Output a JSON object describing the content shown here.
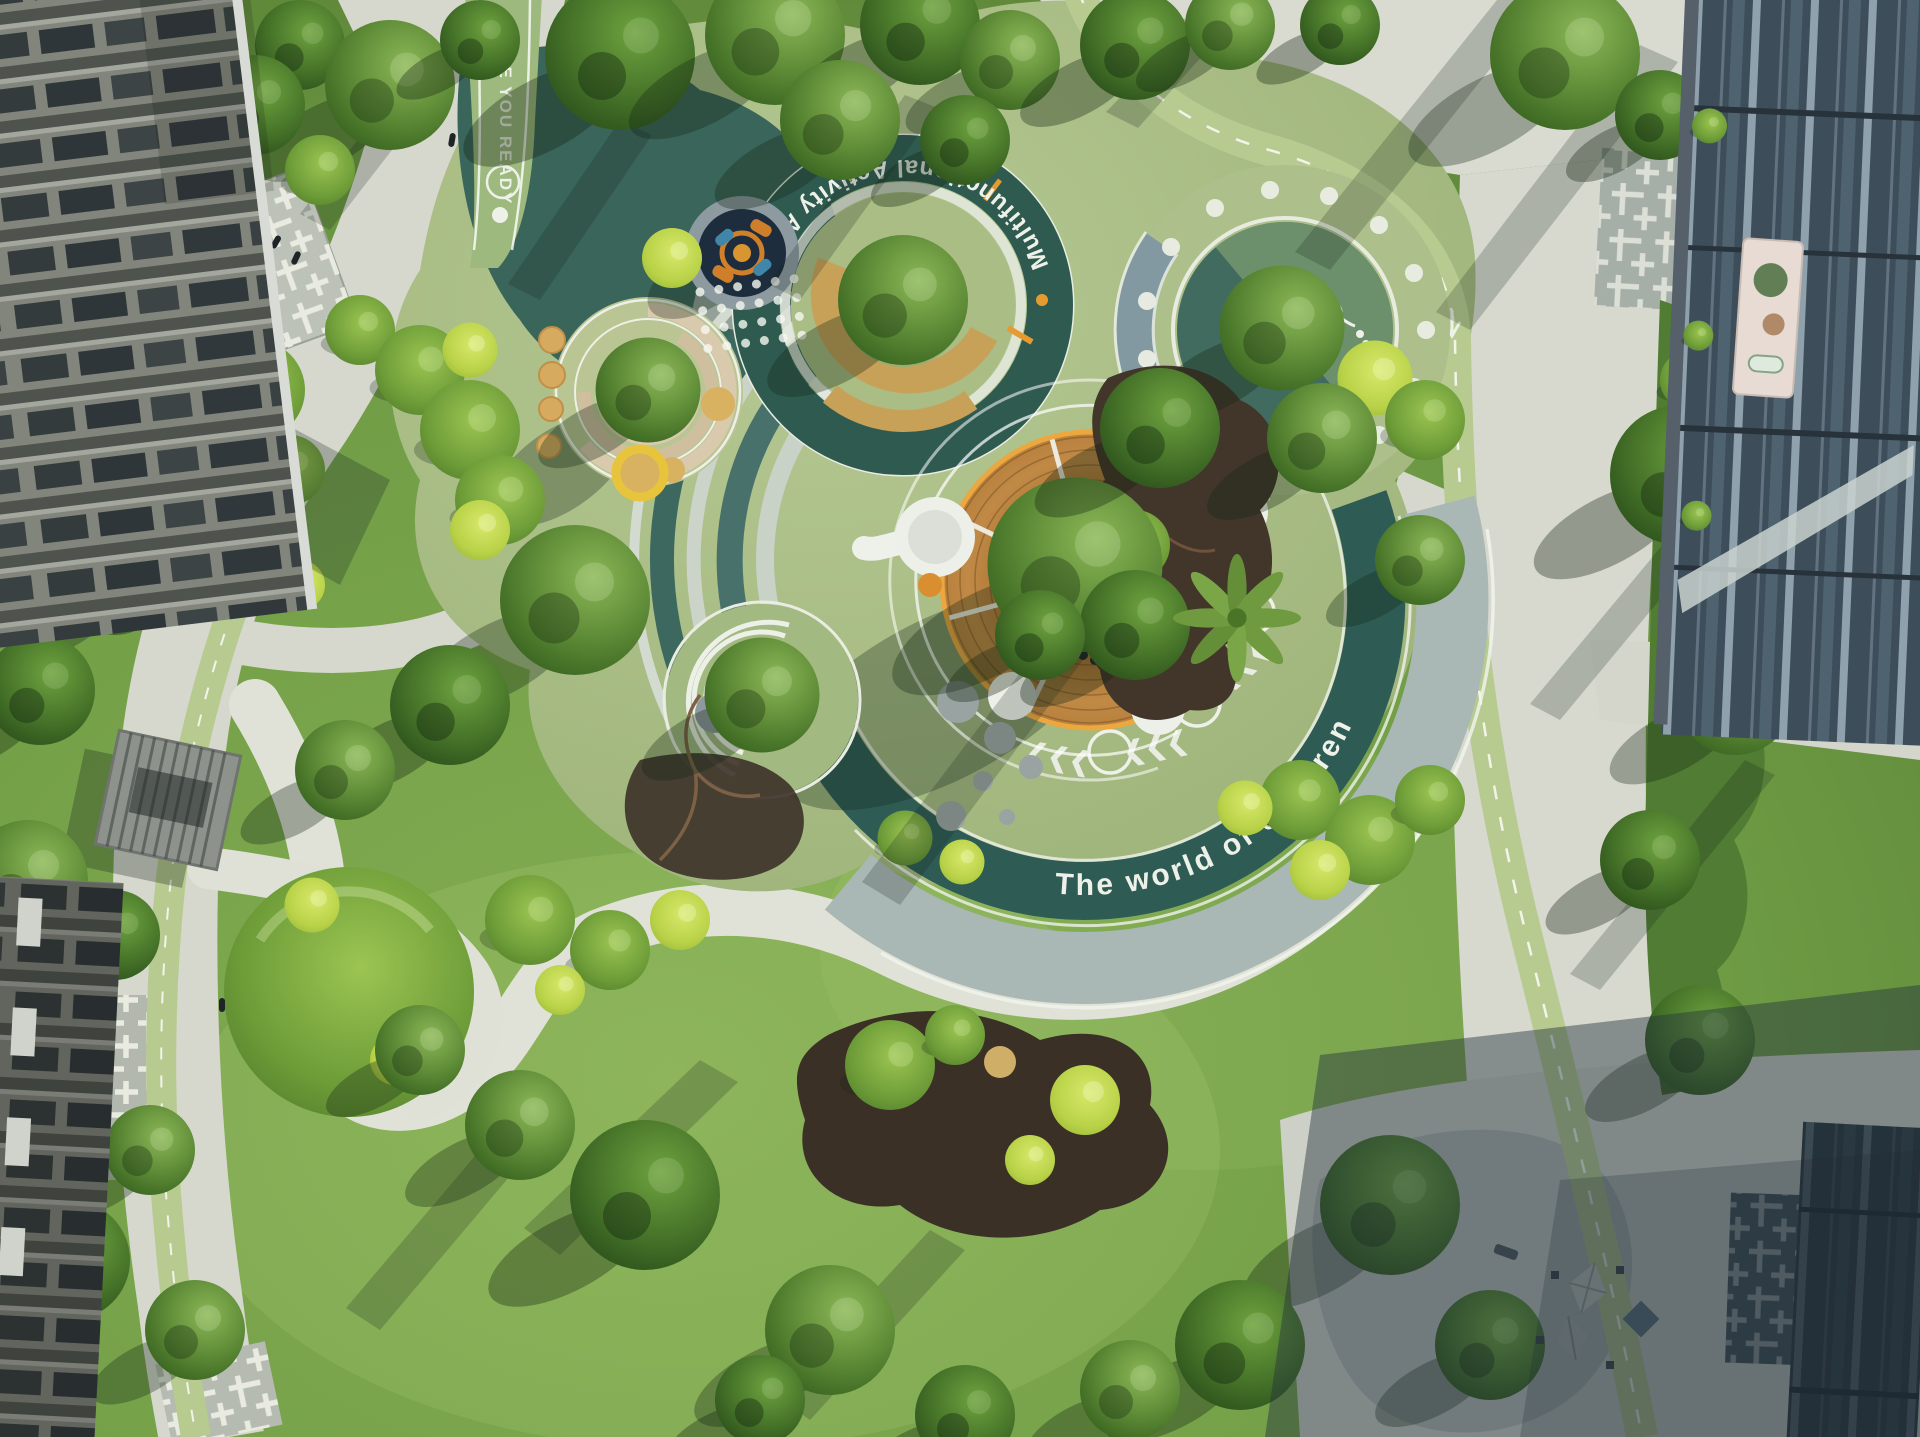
{
  "meta": {
    "type": "aerial-photograph",
    "subject": "Top-down drone view of a residential courtyard children's park with circular play zones, winding paths, jogging track, lawns and sculpted shrubs between apartment towers",
    "lighting": "Low sun from upper right casting long tree shadows; south-east plaza in building shade"
  },
  "ground_markings": {
    "multifunctional_area": "Multifunctional Activity Area",
    "world_of_children": "The world of children",
    "start": "START",
    "are_you_ready": "ARE YOU READY",
    "chevrons": "❮❮❮"
  },
  "areas": {
    "multifunctional_circle": "Teal ring play circle with central tree and ochre lane",
    "polka_dot_circle": "Polka-dot play circle with central tree and snail marking",
    "tree_deck": "Circular timber play deck around central trees with white slide towers",
    "world_ring": "The-world-of-children ring with chevrons and circles around the tree deck",
    "spiral_garden": "Spiral ramp play structure around a tree on sand",
    "carousel": "Spinner carousel on dark rubber pad with dotted paving",
    "bench_circle": "Tree circle with curved white benches",
    "jogging_track": "Light-green jogging loop with dashed white centreline",
    "lawns": "Open lawns with sculpted shrub mounds and dark mulch beds",
    "pergola": "Grey slatted pergola beside the west path",
    "plaza_umbrellas": "Shaded south-east plaza with parasols and seats",
    "buildings": "Apartment towers framing the courtyard on west and east"
  },
  "palette": {
    "grass": "#6f9c45",
    "grass_light": "#86b055",
    "playground_sage": "#a8bc85",
    "teal_rubber": "#2f5d53",
    "teal_mid": "#47716a",
    "track_green": "#b7cb90",
    "paving": "#d7d9cf",
    "paving_shaded": "#79848c",
    "lattice_line": "#e9ebe1",
    "wood_deck": "#bb813e",
    "deck_trim": "#eda73f",
    "white_structure": "#f0f2ec",
    "sand": "#d8b261",
    "ochre": "#c8a159",
    "mulch": "#3b3026",
    "canopy_dark": "#2d5122",
    "canopy_mid": "#4e7c30",
    "chartreuse": "#b9d248",
    "building_left": "#82857c",
    "building_glass": "#3d4e5a",
    "shade_overlay": "rgba(36,50,60,0.45)"
  }
}
